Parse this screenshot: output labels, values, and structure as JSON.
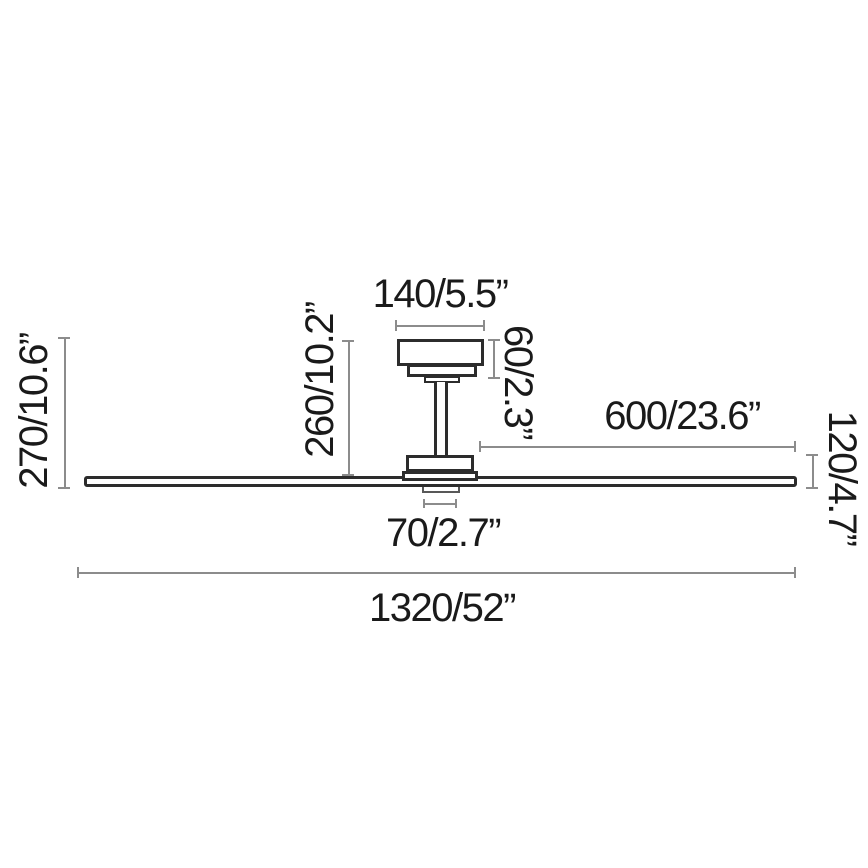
{
  "diagram": {
    "type": "ceiling-fan-dimension-drawing",
    "labels": {
      "canopy_width": "140/5.5”",
      "canopy_height": "60/2.3”",
      "drop_height": "260/10.2”",
      "total_height": "270/10.6”",
      "blade_length": "600/23.6”",
      "motor_height": "120/4.7”",
      "light_diameter": "70/2.7”",
      "total_diameter": "1320/52”"
    },
    "colors": {
      "outline": "#2c2c2c",
      "dimension_line": "#8c8c8c",
      "text": "#1a1a1a",
      "background": "#ffffff"
    }
  }
}
